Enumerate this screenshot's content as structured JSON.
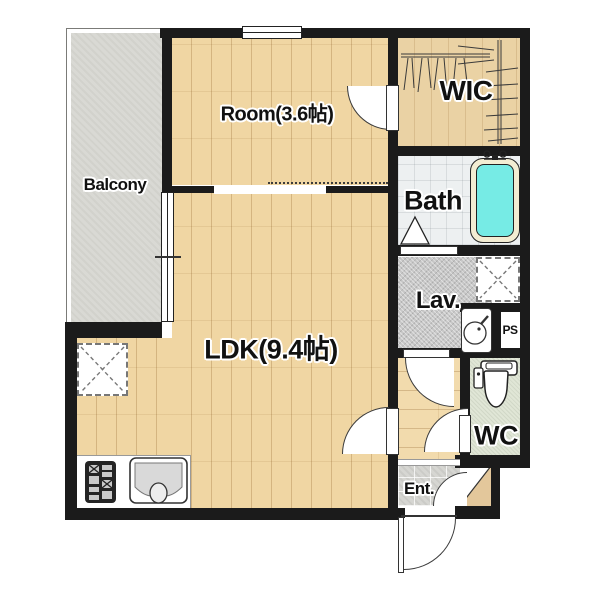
{
  "plan": {
    "type": "apartment-floor-plan",
    "rooms": {
      "balcony": "Balcony",
      "room": "Room(3.6帖)",
      "wic": "WIC",
      "bath": "Bath",
      "lav": "Lav.",
      "ps": "PS",
      "wc": "WC",
      "ent": "Ent.",
      "ldk": "LDK(9.4帖)"
    },
    "fixtures": [
      "bathtub-icon",
      "bath-faucet-icon",
      "toilet-icon",
      "lavatory-sink-icon",
      "kitchen-sink-icon",
      "stove-icon",
      "washing-machine-space",
      "refrigerator-space",
      "clothes-rail-icon",
      "door-swing-arc",
      "entry-door-arc",
      "bath-door-triangle"
    ],
    "colors": {
      "wall": "#1b1b1b",
      "wood_floor": "#f0d6a3",
      "wic_wood": "#ead2a4",
      "balcony_floor": "#d9d9d4",
      "bath_floor": "#edf0f1",
      "lav_floor": "#c7c7c7",
      "wc_floor": "#e0e6d6",
      "ent_floor": "#d6d6d2",
      "tub_water": "#76ebe5",
      "tub_rim": "#f3edd3"
    }
  }
}
